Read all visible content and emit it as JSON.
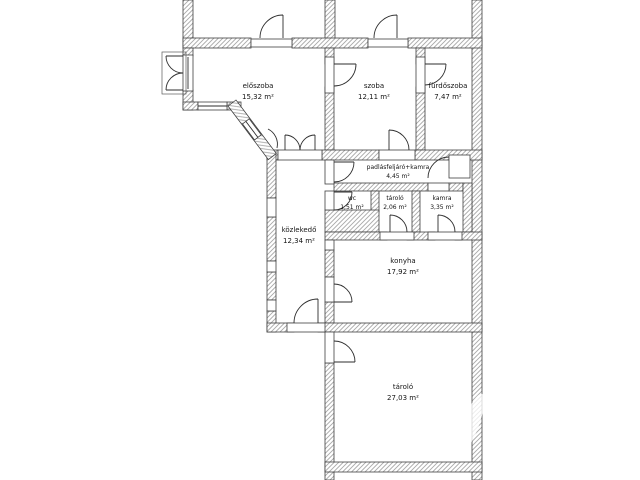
{
  "type": "floor_plan",
  "background": "#ffffff",
  "colors": {
    "wall_hatch": "#a8a8a8",
    "wall_outline": "#3f3f3f",
    "door_line": "#2e2e2e",
    "label_text": "#141414"
  },
  "rooms": [
    {
      "id": "eloszoba",
      "name": "előszoba",
      "area": "15,32 m²"
    },
    {
      "id": "szoba",
      "name": "szoba",
      "area": "12,11 m²"
    },
    {
      "id": "furdoszoba",
      "name": "fürdőszoba",
      "area": "7,47 m²"
    },
    {
      "id": "padlasfeljaro",
      "name": "padlásfeljáró+kamra",
      "area": "4,45 m²"
    },
    {
      "id": "wc",
      "name": "wc",
      "area": "1,51 m²"
    },
    {
      "id": "tarolo-kis",
      "name": "tároló",
      "area": "2,06 m²"
    },
    {
      "id": "kamra",
      "name": "kamra",
      "area": "3,35 m²"
    },
    {
      "id": "kozlekedo",
      "name": "közlekedő",
      "area": "12,34 m²"
    },
    {
      "id": "konyha",
      "name": "konyha",
      "area": "17,92 m²"
    },
    {
      "id": "tarolo-nagy",
      "name": "tároló",
      "area": "27,03 m²"
    }
  ]
}
